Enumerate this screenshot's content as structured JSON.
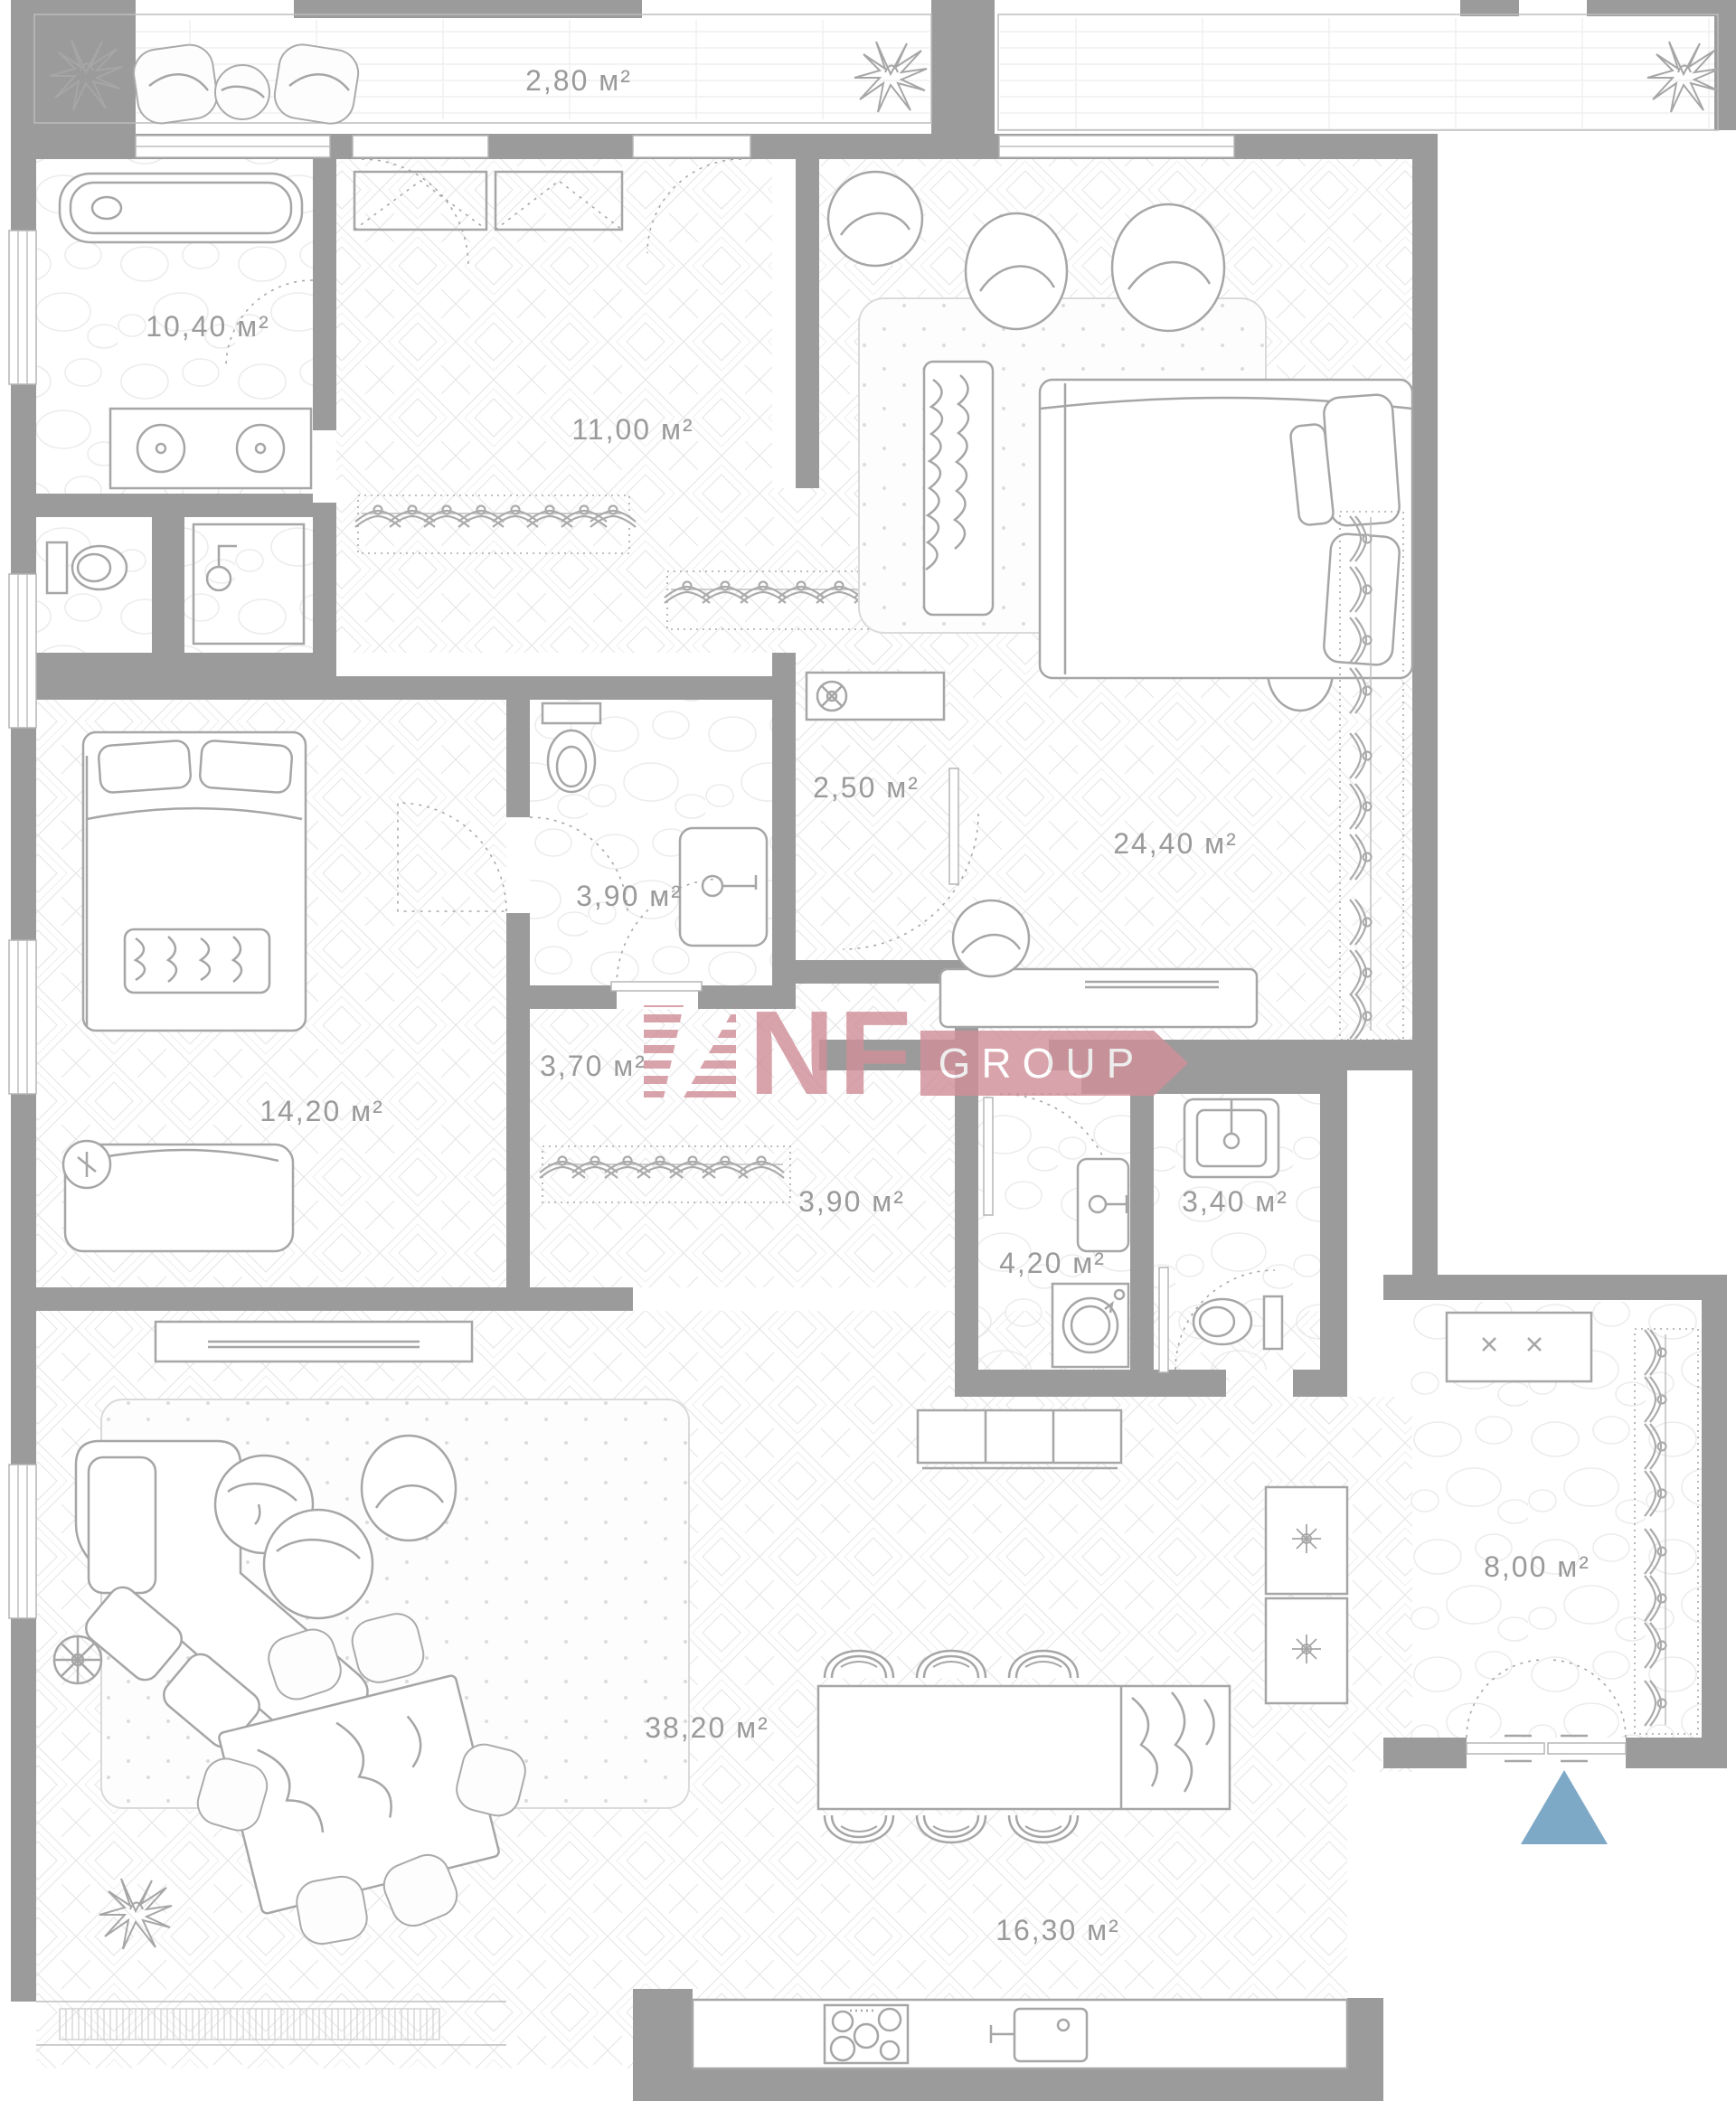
{
  "plan": {
    "title": "apartment-floor-plan",
    "area_unit": "м²",
    "rooms": [
      {
        "id": "balcony",
        "name": "balcony-terrace",
        "label": "2,80 м²"
      },
      {
        "id": "bathroom_master",
        "name": "master-bathroom",
        "label": "10,40 м²"
      },
      {
        "id": "wardrobe_hall",
        "name": "wardrobe-hallway",
        "label": "11,00 м²"
      },
      {
        "id": "bedroom_master",
        "name": "master-bedroom",
        "label": "24,40 м²"
      },
      {
        "id": "hall_nook",
        "name": "hall-nook",
        "label": "2,50 м²"
      },
      {
        "id": "bathroom_2",
        "name": "bathroom-2",
        "label": "3,90 м²"
      },
      {
        "id": "corridor_1",
        "name": "corridor-wardrobe",
        "label": "3,70 м²"
      },
      {
        "id": "bedroom_2",
        "name": "bedroom-2",
        "label": "14,20 м²"
      },
      {
        "id": "corridor_2",
        "name": "corridor-2",
        "label": "3,90 м²"
      },
      {
        "id": "laundry",
        "name": "laundry-room",
        "label": "4,20 м²"
      },
      {
        "id": "wc",
        "name": "wc",
        "label": "3,40 м²"
      },
      {
        "id": "living_room",
        "name": "living-room",
        "label": "38,20 м²"
      },
      {
        "id": "kitchen_dining",
        "name": "kitchen-dining",
        "label": "16,30 м²"
      },
      {
        "id": "entrance_hall",
        "name": "entrance-hall",
        "label": "8,00 м²"
      }
    ],
    "watermark": {
      "brand": "NF",
      "suffix": "GROUP",
      "color": "#d08f98"
    },
    "entrance_marker": {
      "shape": "triangle-up",
      "color": "#7ea9c6"
    },
    "colors": {
      "wall": "#9b9b9b",
      "furniture_line": "#a6a6a6",
      "label": "#9a9a9a",
      "floor_pattern": "#e7e7ea"
    }
  }
}
